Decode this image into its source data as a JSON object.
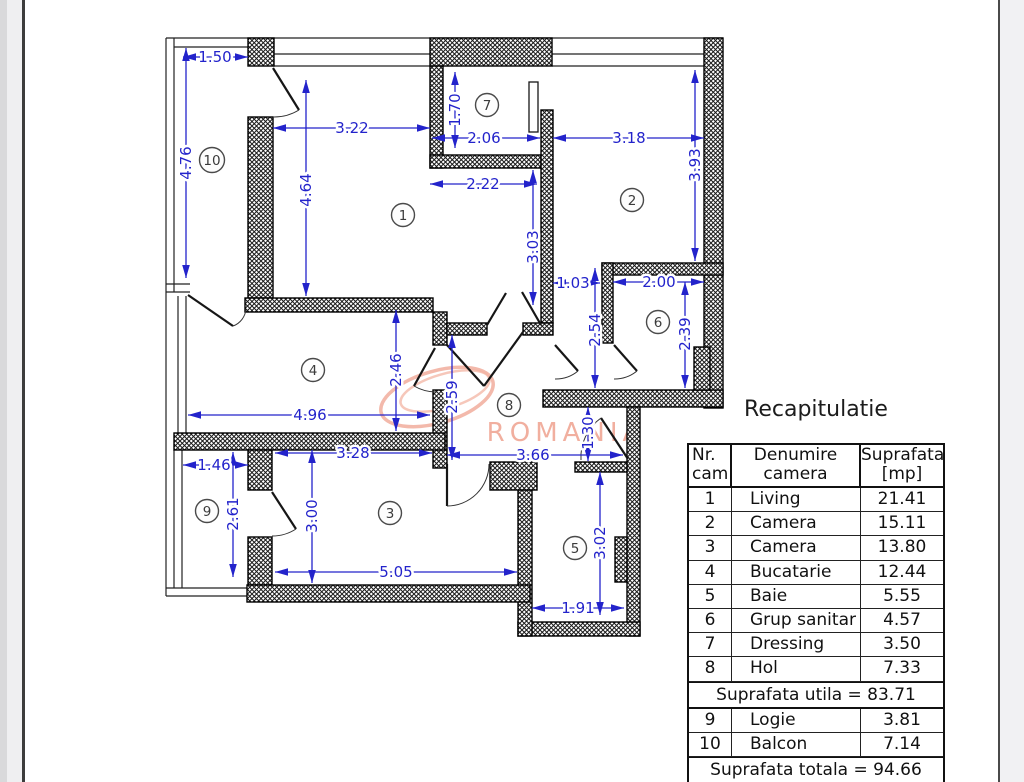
{
  "colors": {
    "dimension_blue": "#2323cb",
    "wall_black": "#111111",
    "watermark_salmon": "#efa28f",
    "page_white": "#ffffff"
  },
  "plan": {
    "watermark": {
      "text": "ROMANIA",
      "color": "#efa28f"
    },
    "rooms": [
      {
        "nr": "1"
      },
      {
        "nr": "2"
      },
      {
        "nr": "3"
      },
      {
        "nr": "4"
      },
      {
        "nr": "5"
      },
      {
        "nr": "6"
      },
      {
        "nr": "7"
      },
      {
        "nr": "8"
      },
      {
        "nr": "9"
      },
      {
        "nr": "10"
      }
    ],
    "dims": [
      {
        "label": "1.50"
      },
      {
        "label": "4.76"
      },
      {
        "label": "3.22"
      },
      {
        "label": "4.64"
      },
      {
        "label": "1.70"
      },
      {
        "label": "2.06"
      },
      {
        "label": "2.22"
      },
      {
        "label": "3.03"
      },
      {
        "label": "3.18"
      },
      {
        "label": "3.93"
      },
      {
        "label": "1.03"
      },
      {
        "label": "2.00"
      },
      {
        "label": "2.54"
      },
      {
        "label": "2.39"
      },
      {
        "label": "2.46"
      },
      {
        "label": "4.96"
      },
      {
        "label": "2.59"
      },
      {
        "label": "3.66"
      },
      {
        "label": "1.30"
      },
      {
        "label": "1.46"
      },
      {
        "label": "2.61"
      },
      {
        "label": "3.28"
      },
      {
        "label": "3.00"
      },
      {
        "label": "5.05"
      },
      {
        "label": "3.02"
      },
      {
        "label": "1.91"
      }
    ]
  },
  "table": {
    "title": "Recapitulatie",
    "header": {
      "col1_line1": "Nr.",
      "col1_line2": "cam.",
      "col2_line1": "Denumire",
      "col2_line2": "camera",
      "col3_line1": "Suprafata",
      "col3_line2": "[mp]"
    },
    "rows": [
      {
        "nr": "1",
        "name": "Living",
        "area": "21.41"
      },
      {
        "nr": "2",
        "name": "Camera",
        "area": "15.11"
      },
      {
        "nr": "3",
        "name": "Camera",
        "area": "13.80"
      },
      {
        "nr": "4",
        "name": "Bucatarie",
        "area": "12.44"
      },
      {
        "nr": "5",
        "name": "Baie",
        "area": "5.55"
      },
      {
        "nr": "6",
        "name": "Grup sanitar",
        "area": "4.57"
      },
      {
        "nr": "7",
        "name": "Dressing",
        "area": "3.50"
      },
      {
        "nr": "8",
        "name": "Hol",
        "area": "7.33"
      }
    ],
    "subtotal": "Suprafata utila = 83.71",
    "rows_annex": [
      {
        "nr": "9",
        "name": "Logie",
        "area": "3.81"
      },
      {
        "nr": "10",
        "name": "Balcon",
        "area": "7.14"
      }
    ],
    "total": "Suprafata totala = 94.66"
  }
}
